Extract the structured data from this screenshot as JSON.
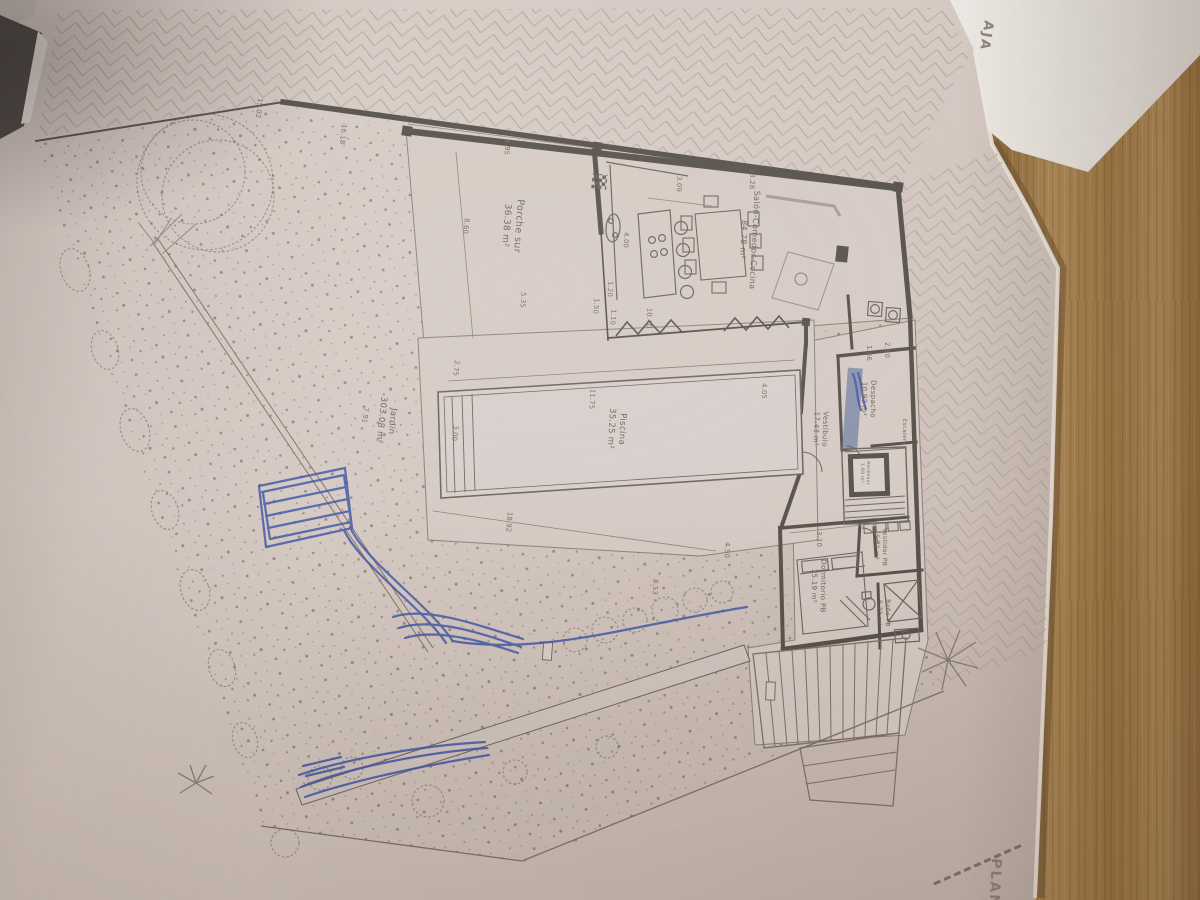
{
  "document": {
    "sheet_title_fragment_top": "AJA",
    "sheet_title_fragment_bottom": "PLAN"
  },
  "rooms": [
    {
      "name": "Porche sur",
      "area": "36.38 m²"
    },
    {
      "name": "Salón-Comedor-Cocina",
      "area": "84.78 m²"
    },
    {
      "name": "Piscina",
      "area": "35.25 m²"
    },
    {
      "name": "Jardín",
      "area": "303.08 m²"
    },
    {
      "name": "Despacho",
      "area": "10.92 m²"
    },
    {
      "name": "Vestíbulo",
      "area": "17.43 m²"
    },
    {
      "name": "Dormitorio PB",
      "area": "15.19 m²"
    },
    {
      "name": "Vestidor PB",
      "area": "6.72 m²"
    },
    {
      "name": "Baño PB",
      "area": "6.22 m²"
    },
    {
      "name": "Ascensor",
      "area": "1.69 m²"
    },
    {
      "name": "Escalera",
      "area": ""
    }
  ],
  "dims": [
    "15.02",
    "16.18",
    "6.95",
    "3.09",
    "13.28",
    "8.60",
    "4.00",
    "1.20",
    "5.35",
    "1.50",
    "1.10",
    "10.40",
    "2.75",
    "11.75",
    "3.00",
    "4.05",
    "7.51",
    "18.92",
    "8.53",
    "4.50",
    "3.10",
    "2.80",
    "1.86"
  ],
  "colors": {
    "paper": "#d5c9c2",
    "ink": "#6b6259",
    "wall": "#554f49",
    "pen_blue": "#3e54a6",
    "wood": "#a8824e"
  }
}
